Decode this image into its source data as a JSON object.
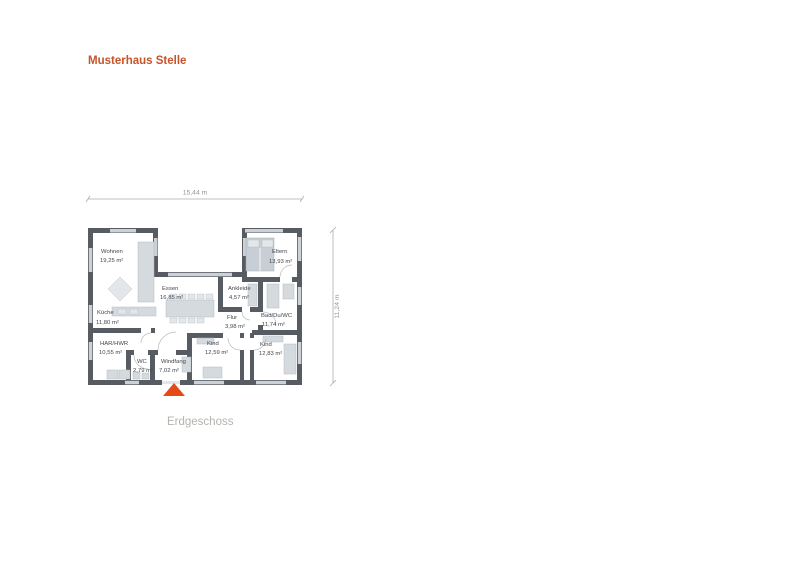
{
  "page": {
    "title": "Musterhaus Stelle",
    "floor_label": "Erdgeschoss"
  },
  "dimensions": {
    "width_label": "15,44 m",
    "height_label": "11,24 m"
  },
  "rooms": [
    {
      "name": "Wohnen",
      "area": "19,25 m²"
    },
    {
      "name": "Essen",
      "area": "16,85 m²"
    },
    {
      "name": "Eltern",
      "area": "13,93 m²"
    },
    {
      "name": "Ankleide",
      "area": "4,57 m²"
    },
    {
      "name": "Küche",
      "area": "11,80 m²"
    },
    {
      "name": "Flur",
      "area": "3,98 m²"
    },
    {
      "name": "Bad/Du/WC",
      "area": "11,74 m²"
    },
    {
      "name": "HAR/HWR",
      "area": "10,55 m²"
    },
    {
      "name": "WC",
      "area": "2,79 m²"
    },
    {
      "name": "Windfang",
      "area": "7,02 m²"
    },
    {
      "name": "Kind",
      "area": "12,59 m²"
    },
    {
      "name": "Kind",
      "area": "12,83 m²"
    }
  ],
  "colors": {
    "title": "#c75329",
    "wall": "#575c63",
    "furniture": "#d5dade",
    "window": "#cbd1d7",
    "entrance_marker": "#e44a17",
    "floor_label_text": "#b4b4ae",
    "dimension_text": "#8f959a",
    "room_text": "#41474e"
  }
}
